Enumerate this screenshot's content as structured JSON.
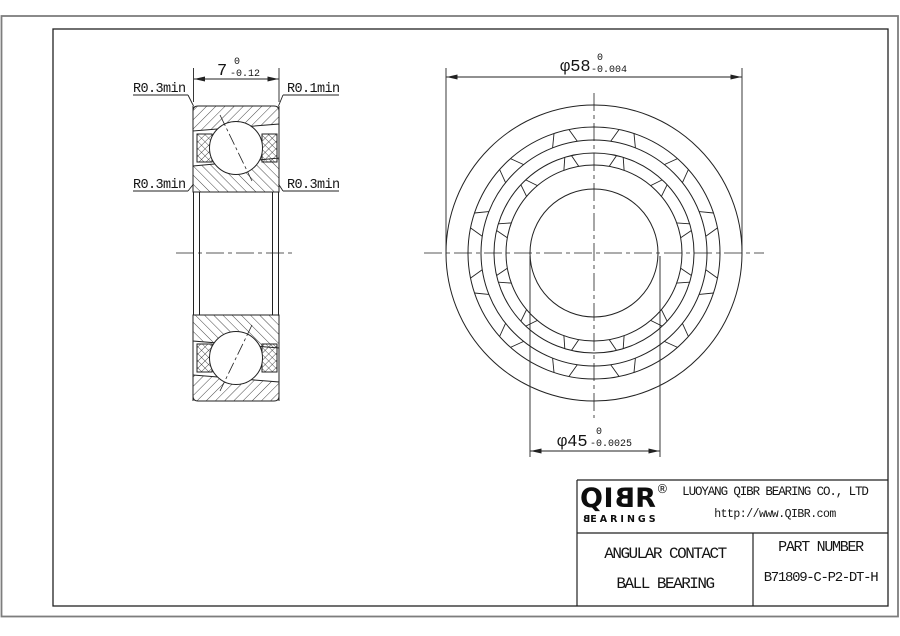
{
  "drawing": {
    "dim_width": {
      "nominal": "7",
      "tol_upper": "0",
      "tol_lower": "-0.12"
    },
    "dim_outer_diameter": {
      "nominal": "φ58",
      "tol_upper": "0",
      "tol_lower": "-0.004"
    },
    "dim_bore_diameter": {
      "nominal": "φ45",
      "tol_upper": "0",
      "tol_lower": "-0.0025"
    },
    "radius_labels": {
      "top_left": "R0.3min",
      "top_right": "R0.1min",
      "mid_left": "R0.3min",
      "mid_right": "R0.3min"
    },
    "line_color": "#222222"
  },
  "title_block": {
    "logo": {
      "brand_prefix": "QI",
      "brand_mirrored_letter": "B",
      "brand_suffix": "R",
      "registered": "®",
      "sub_mirrored_letter": "B",
      "sub_suffix": "EARINGS"
    },
    "company_name": "LUOYANG QIBR BEARING CO., LTD",
    "website": "http://www.QIBR.com",
    "product_name_line1": "ANGULAR CONTACT",
    "product_name_line2": "BALL BEARING",
    "part_number_label": "PART NUMBER",
    "part_number": "B71809-C-P2-DT-H"
  }
}
